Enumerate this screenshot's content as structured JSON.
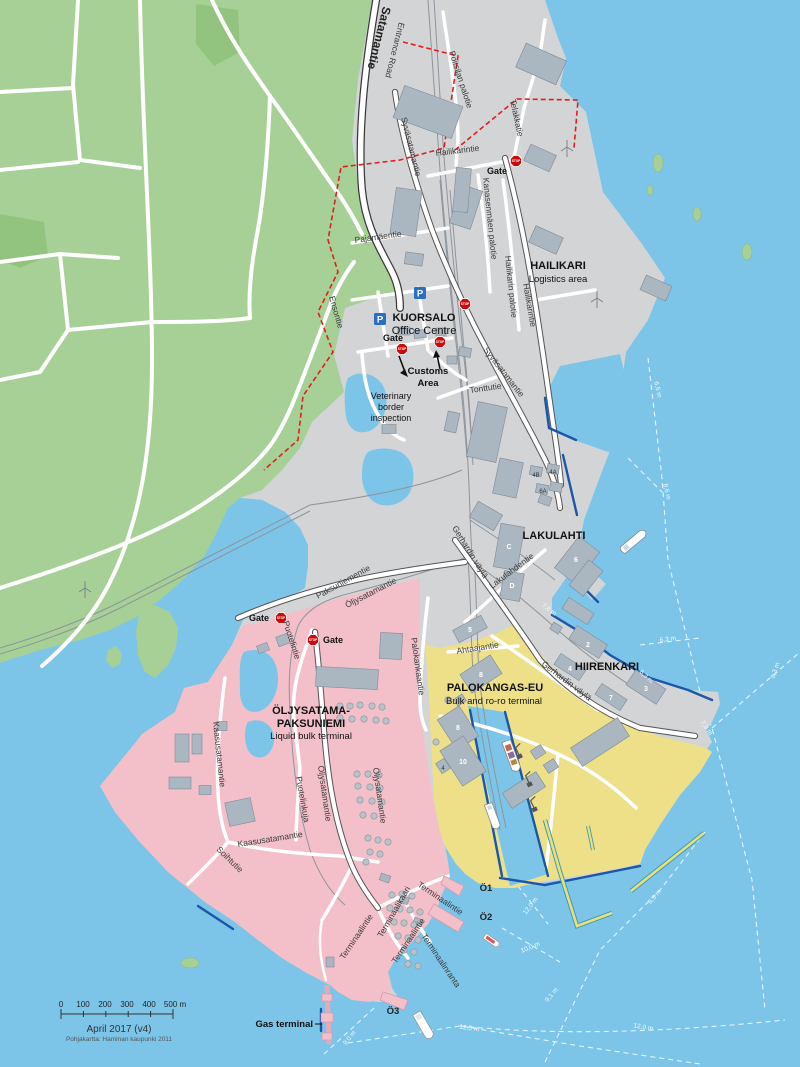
{
  "map": {
    "attribution": {
      "date": "April 2017 (v4)",
      "source": "Pohjakartta: Haminan kaupunki 2011"
    },
    "icons": {
      "stop_text": "STOP",
      "parking_letter": "P",
      "stops": [
        {
          "x": 516,
          "y": 161
        },
        {
          "x": 465,
          "y": 304
        },
        {
          "x": 440,
          "y": 342
        },
        {
          "x": 402,
          "y": 349
        },
        {
          "x": 281,
          "y": 618
        },
        {
          "x": 313,
          "y": 640
        }
      ],
      "parkings": [
        {
          "x": 420,
          "y": 293
        },
        {
          "x": 380,
          "y": 319
        }
      ]
    },
    "labels": [
      {
        "name": "road-satamantie",
        "text": "Satamantie",
        "x": 383,
        "y": 6,
        "r": 104,
        "cls": "road-lg",
        "a": "s"
      },
      {
        "name": "road-entrance-road",
        "text": "Entrance Road",
        "x": 399,
        "y": 22,
        "r": 104,
        "cls": "road",
        "a": "s"
      },
      {
        "name": "road-poitsilan-palotie",
        "text": "Poitsilan palotie",
        "x": 449,
        "y": 52,
        "r": 72,
        "cls": "road",
        "a": "s"
      },
      {
        "name": "road-telakkatie",
        "text": "Telakkatie",
        "x": 510,
        "y": 100,
        "r": 78,
        "cls": "road",
        "a": "s"
      },
      {
        "name": "road-hailikarintie-north",
        "text": "Hailikarintie",
        "x": 436,
        "y": 156,
        "r": -7,
        "cls": "road",
        "a": "s"
      },
      {
        "name": "road-kanasenmaen-palotie",
        "text": "Kanasenmäen palotie",
        "x": 483,
        "y": 178,
        "r": 84,
        "cls": "road",
        "a": "s"
      },
      {
        "name": "road-hailikarin-palotie",
        "text": "Hailikarin palotie",
        "x": 505,
        "y": 256,
        "r": 84,
        "cls": "road",
        "a": "s"
      },
      {
        "name": "road-hailikarintie-coast",
        "text": "Hailikarintie",
        "x": 523,
        "y": 284,
        "r": 80,
        "cls": "road",
        "a": "s"
      },
      {
        "name": "area-hailikari",
        "text": "HAILIKARI",
        "x": 558,
        "y": 269,
        "r": 0,
        "cls": "area-title",
        "a": "m"
      },
      {
        "name": "area-hailikari-sub",
        "text": "Logistics area",
        "x": 558,
        "y": 282,
        "r": 0,
        "cls": "area-sub",
        "a": "m"
      },
      {
        "name": "road-pajamaentie",
        "text": "Pajamäentie",
        "x": 355,
        "y": 243,
        "r": -8,
        "cls": "road",
        "a": "s"
      },
      {
        "name": "road-syvasatamantie-1",
        "text": "Syväsatamantie",
        "x": 401,
        "y": 118,
        "r": 76,
        "cls": "road",
        "a": "s"
      },
      {
        "name": "road-syvasatamantie-2",
        "text": "Syväsatamantie",
        "x": 483,
        "y": 350,
        "r": 52,
        "cls": "road",
        "a": "s"
      },
      {
        "name": "road-ensontie",
        "text": "Ensontie",
        "x": 329,
        "y": 297,
        "r": 74,
        "cls": "road",
        "a": "s"
      },
      {
        "name": "area-kuorsalo",
        "text": "KUORSALO",
        "x": 424,
        "y": 321,
        "r": 0,
        "cls": "area-title",
        "a": "m"
      },
      {
        "name": "area-kuorsalo-sub",
        "text": "Office Centre",
        "x": 424,
        "y": 334,
        "r": 0,
        "cls": "area-sub-lg",
        "a": "m"
      },
      {
        "name": "gate-kuorsalo",
        "text": "Gate",
        "x": 393,
        "y": 341,
        "r": 0,
        "cls": "gate",
        "a": "m"
      },
      {
        "name": "customs-line1",
        "text": "Customs",
        "x": 428,
        "y": 374,
        "r": 0,
        "cls": "label-bold",
        "a": "m"
      },
      {
        "name": "customs-line2",
        "text": "Area",
        "x": 428,
        "y": 386,
        "r": 0,
        "cls": "label-bold",
        "a": "m"
      },
      {
        "name": "vet-line1",
        "text": "Veterinary",
        "x": 391,
        "y": 399,
        "r": 0,
        "cls": "label",
        "a": "m"
      },
      {
        "name": "vet-line2",
        "text": "border",
        "x": 391,
        "y": 410,
        "r": 0,
        "cls": "label",
        "a": "m"
      },
      {
        "name": "vet-line3",
        "text": "inspection",
        "x": 391,
        "y": 421,
        "r": 0,
        "cls": "label",
        "a": "m"
      },
      {
        "name": "road-tonttutie",
        "text": "Tonttutie",
        "x": 470,
        "y": 393,
        "r": -8,
        "cls": "road",
        "a": "s"
      },
      {
        "name": "area-lakulahti",
        "text": "LAKULAHTI",
        "x": 554,
        "y": 539,
        "r": 0,
        "cls": "area-title",
        "a": "m"
      },
      {
        "name": "road-gerhardin-vayla-1",
        "text": "Gerhardin väylä",
        "x": 452,
        "y": 528,
        "r": 58,
        "cls": "road",
        "a": "s"
      },
      {
        "name": "road-gerhardin-vayla-2",
        "text": "Gerhardin väylä",
        "x": 541,
        "y": 665,
        "r": 37,
        "cls": "road",
        "a": "s"
      },
      {
        "name": "road-lakulahdentie",
        "text": "Lakulahdentie",
        "x": 492,
        "y": 589,
        "r": -37,
        "cls": "road",
        "a": "s"
      },
      {
        "name": "road-ahtaajantie",
        "text": "Ahtaajantie",
        "x": 457,
        "y": 654,
        "r": -9,
        "cls": "road",
        "a": "s"
      },
      {
        "name": "area-hiirenkari",
        "text": "HIIRENKARI",
        "x": 607,
        "y": 670,
        "r": 0,
        "cls": "area-title",
        "a": "m"
      },
      {
        "name": "area-palokangas",
        "text": "PALOKANGAS-EU",
        "x": 495,
        "y": 691,
        "r": 0,
        "cls": "area-title",
        "a": "m"
      },
      {
        "name": "area-palokangas-sub",
        "text": "Bulk and ro-ro terminal",
        "x": 494,
        "y": 704,
        "r": 0,
        "cls": "area-sub",
        "a": "m"
      },
      {
        "name": "area-oljysatama-1",
        "text": "ÖLJYSATAMA-",
        "x": 311,
        "y": 714,
        "r": 0,
        "cls": "area-title",
        "a": "m"
      },
      {
        "name": "area-oljysatama-2",
        "text": "PAKSUNIEMI",
        "x": 311,
        "y": 727,
        "r": 0,
        "cls": "area-title",
        "a": "m"
      },
      {
        "name": "area-oljysatama-sub",
        "text": "Liquid bulk terminal",
        "x": 311,
        "y": 739,
        "r": 0,
        "cls": "area-sub",
        "a": "m"
      },
      {
        "name": "road-paksuniementie",
        "text": "Paksuniementie",
        "x": 318,
        "y": 599,
        "r": -29,
        "cls": "road",
        "a": "s"
      },
      {
        "name": "road-oljysatamantie-1",
        "text": "Öljysatamantie",
        "x": 347,
        "y": 608,
        "r": -27,
        "cls": "road",
        "a": "s"
      },
      {
        "name": "gate-paksuniemi",
        "text": "Gate",
        "x": 259,
        "y": 621,
        "r": 0,
        "cls": "gate",
        "a": "m"
      },
      {
        "name": "gate-oljysatama",
        "text": "Gate",
        "x": 333,
        "y": 643,
        "r": 0,
        "cls": "gate",
        "a": "m"
      },
      {
        "name": "gate-hailikari",
        "text": "Gate",
        "x": 497,
        "y": 174,
        "r": 0,
        "cls": "gate",
        "a": "m"
      },
      {
        "name": "road-puotelintie",
        "text": "Puotelintie",
        "x": 283,
        "y": 622,
        "r": 72,
        "cls": "road",
        "a": "s"
      },
      {
        "name": "road-palokankaantie",
        "text": "Palokankaantie",
        "x": 411,
        "y": 638,
        "r": 82,
        "cls": "road",
        "a": "s"
      },
      {
        "name": "road-kaasusatamantie-1",
        "text": "Kaasusatamantie",
        "x": 213,
        "y": 722,
        "r": 84,
        "cls": "road",
        "a": "s"
      },
      {
        "name": "road-kaasusatamantie-2",
        "text": "Kaasusatamantie",
        "x": 238,
        "y": 847,
        "r": -9,
        "cls": "road",
        "a": "s"
      },
      {
        "name": "road-soihtutie",
        "text": "Soihtutie",
        "x": 216,
        "y": 850,
        "r": 44,
        "cls": "road",
        "a": "s"
      },
      {
        "name": "road-puotelinkuja",
        "text": "Puotelinkuja",
        "x": 296,
        "y": 777,
        "r": 80,
        "cls": "road",
        "a": "s"
      },
      {
        "name": "road-oljysatamantie-2",
        "text": "Öljysatamantie",
        "x": 318,
        "y": 766,
        "r": 82,
        "cls": "road",
        "a": "s"
      },
      {
        "name": "road-oljysatamantie-3",
        "text": "Öljysatamantie",
        "x": 373,
        "y": 768,
        "r": 82,
        "cls": "road",
        "a": "s"
      },
      {
        "name": "road-terminaalikaari",
        "text": "Terminaalikaari",
        "x": 382,
        "y": 938,
        "r": -60,
        "cls": "road",
        "a": "s"
      },
      {
        "name": "road-terminaalintie-1",
        "text": "Terminaalintie",
        "x": 417,
        "y": 886,
        "r": 34,
        "cls": "road",
        "a": "s"
      },
      {
        "name": "road-terminaalintie-2",
        "text": "Terminaalintie",
        "x": 396,
        "y": 964,
        "r": -56,
        "cls": "road",
        "a": "s"
      },
      {
        "name": "road-terminaalinranta",
        "text": "Terminaalinranta",
        "x": 421,
        "y": 936,
        "r": 56,
        "cls": "road",
        "a": "s"
      },
      {
        "name": "road-terminaalintie-3",
        "text": "Terminaalintie",
        "x": 344,
        "y": 960,
        "r": -56,
        "cls": "road",
        "a": "s"
      },
      {
        "name": "pier-o1",
        "text": "Ö1",
        "x": 486,
        "y": 891,
        "r": 0,
        "cls": "pier",
        "a": "m"
      },
      {
        "name": "pier-o2",
        "text": "Ö2",
        "x": 486,
        "y": 920,
        "r": 0,
        "cls": "pier",
        "a": "m"
      },
      {
        "name": "pier-o3",
        "text": "Ö3",
        "x": 393,
        "y": 1014,
        "r": 0,
        "cls": "pier",
        "a": "m"
      },
      {
        "name": "gas-terminal",
        "text": "Gas terminal",
        "x": 313,
        "y": 1027,
        "r": 0,
        "cls": "label-bold",
        "a": "e"
      },
      {
        "name": "bldg-num-2",
        "text": "2",
        "x": 588,
        "y": 647,
        "r": 0,
        "cls": "bnum",
        "a": "m"
      },
      {
        "name": "bldg-num-4",
        "text": "4",
        "x": 570,
        "y": 671,
        "r": 0,
        "cls": "bnum",
        "a": "m"
      },
      {
        "name": "bldg-num-7",
        "text": "7",
        "x": 611,
        "y": 700,
        "r": 0,
        "cls": "bnum",
        "a": "m"
      },
      {
        "name": "bldg-num-3",
        "text": "3",
        "x": 646,
        "y": 691,
        "r": 0,
        "cls": "bnum",
        "a": "m"
      },
      {
        "name": "bldg-num-5",
        "text": "5",
        "x": 470,
        "y": 632,
        "r": 0,
        "cls": "bnum",
        "a": "m"
      },
      {
        "name": "bldg-num-c",
        "text": "C",
        "x": 509,
        "y": 549,
        "r": 0,
        "cls": "bnum",
        "a": "m"
      },
      {
        "name": "bldg-num-d",
        "text": "D",
        "x": 512,
        "y": 588,
        "r": 0,
        "cls": "bnum",
        "a": "m"
      },
      {
        "name": "bldg-num-6",
        "text": "6",
        "x": 576,
        "y": 562,
        "r": 0,
        "cls": "bnum",
        "a": "m"
      },
      {
        "name": "bldg-num-8a",
        "text": "8",
        "x": 481,
        "y": 677,
        "r": 0,
        "cls": "bnum",
        "a": "m"
      },
      {
        "name": "bldg-num-8b",
        "text": "8",
        "x": 458,
        "y": 730,
        "r": 0,
        "cls": "bnum",
        "a": "m"
      },
      {
        "name": "bldg-num-10",
        "text": "10",
        "x": 463,
        "y": 764,
        "r": 0,
        "cls": "bnum",
        "a": "m"
      },
      {
        "name": "bldg-num-4b",
        "text": "4B",
        "x": 536,
        "y": 477,
        "r": 0,
        "cls": "bnum-dark",
        "a": "m"
      },
      {
        "name": "bldg-num-4a",
        "text": "4A",
        "x": 553,
        "y": 474,
        "r": 0,
        "cls": "bnum-dark",
        "a": "m"
      },
      {
        "name": "bldg-num-6a",
        "text": "6A",
        "x": 543,
        "y": 493,
        "r": 0,
        "cls": "bnum-dark",
        "a": "m"
      },
      {
        "name": "bldg-num-4s",
        "text": "4",
        "x": 443,
        "y": 770,
        "r": 0,
        "cls": "bnum-dark",
        "a": "m"
      },
      {
        "name": "depth-7-6",
        "text": "7,6 m",
        "x": 548,
        "y": 611,
        "r": 38,
        "cls": "depth",
        "a": "m"
      },
      {
        "name": "depth-6-3a",
        "text": "6,3 m",
        "x": 668,
        "y": 641,
        "r": -8,
        "cls": "depth",
        "a": "m"
      },
      {
        "name": "depth-6-3b",
        "text": "6,3 m",
        "x": 645,
        "y": 678,
        "r": 42,
        "cls": "depth",
        "a": "m"
      },
      {
        "name": "depth-6-5",
        "text": "6,5 m",
        "x": 656,
        "y": 390,
        "r": 78,
        "cls": "depth",
        "a": "m"
      },
      {
        "name": "depth-8-6",
        "text": "8,6 m",
        "x": 665,
        "y": 492,
        "r": 78,
        "cls": "depth",
        "a": "m"
      },
      {
        "name": "depth-8-3a",
        "text": "8,3 m",
        "x": 777,
        "y": 671,
        "r": -72,
        "cls": "depth",
        "a": "m"
      },
      {
        "name": "depth-7-9",
        "text": "7,9 m",
        "x": 705,
        "y": 729,
        "r": 56,
        "cls": "depth",
        "a": "m"
      },
      {
        "name": "depth-8-3b",
        "text": "8,3 m",
        "x": 656,
        "y": 898,
        "r": -50,
        "cls": "depth",
        "a": "m"
      },
      {
        "name": "depth-9-1",
        "text": "9,1 m",
        "x": 553,
        "y": 996,
        "r": -50,
        "cls": "depth",
        "a": "m"
      },
      {
        "name": "depth-12-0a",
        "text": "12,0 m",
        "x": 469,
        "y": 1030,
        "r": 8,
        "cls": "depth",
        "a": "m"
      },
      {
        "name": "depth-12-0b",
        "text": "12,0 m",
        "x": 643,
        "y": 1029,
        "r": 10,
        "cls": "depth",
        "a": "m"
      },
      {
        "name": "depth-10-0",
        "text": "10,0 m",
        "x": 531,
        "y": 949,
        "r": -22,
        "cls": "depth",
        "a": "m"
      },
      {
        "name": "depth-12-0c",
        "text": "12,0 m",
        "x": 532,
        "y": 907,
        "r": -52,
        "cls": "depth",
        "a": "m"
      },
      {
        "name": "depth-9-0",
        "text": "9,0 m",
        "x": 351,
        "y": 1039,
        "r": -52,
        "cls": "depth",
        "a": "m"
      },
      {
        "name": "scale-0",
        "text": "0",
        "x": 61,
        "y": 1007,
        "r": 0,
        "cls": "scale",
        "a": "m"
      },
      {
        "name": "scale-100",
        "text": "100",
        "x": 83,
        "y": 1007,
        "r": 0,
        "cls": "scale",
        "a": "m"
      },
      {
        "name": "scale-200",
        "text": "200",
        "x": 105,
        "y": 1007,
        "r": 0,
        "cls": "scale",
        "a": "m"
      },
      {
        "name": "scale-300",
        "text": "300",
        "x": 127,
        "y": 1007,
        "r": 0,
        "cls": "scale",
        "a": "m"
      },
      {
        "name": "scale-400",
        "text": "400",
        "x": 149,
        "y": 1007,
        "r": 0,
        "cls": "scale",
        "a": "m"
      },
      {
        "name": "scale-500",
        "text": "500 m",
        "x": 175,
        "y": 1007,
        "r": 0,
        "cls": "scale",
        "a": "m"
      },
      {
        "name": "map-date",
        "text": "April 2017 (v4)",
        "x": 119,
        "y": 1032,
        "r": 0,
        "cls": "attr1",
        "a": "m"
      },
      {
        "name": "map-source",
        "text": "Pohjakartta: Haminan kaupunki 2011",
        "x": 119,
        "y": 1041,
        "r": 0,
        "cls": "attr2",
        "a": "m"
      }
    ],
    "colors": {
      "sea": "#7cc5e9",
      "land_green": "#a7d096",
      "forest": "#93c47f",
      "port_grey": "#d3d4d6",
      "oil_terminal_pink": "#f3bfc9",
      "bulk_terminal_yellow": "#eee089",
      "building": "#aab6c0",
      "road": "#ffffff",
      "boundary_red": "#e01f1f",
      "quay_blue": "#1a57a8",
      "stop_red": "#cc0a0a",
      "parking_blue": "#2a6fc4"
    }
  }
}
